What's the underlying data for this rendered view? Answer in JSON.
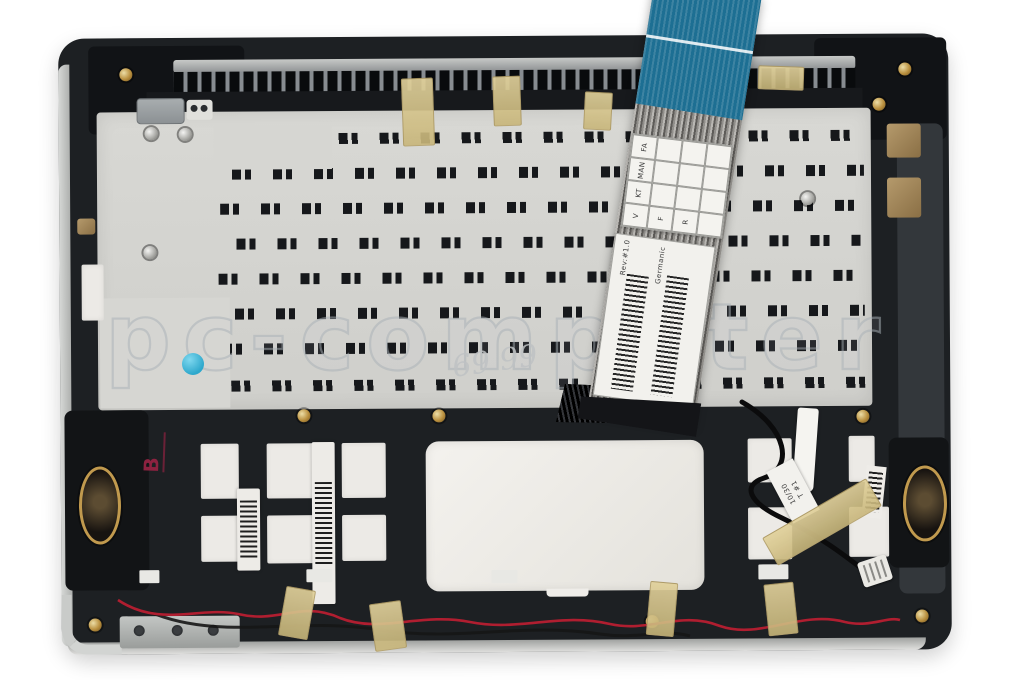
{
  "scene": {
    "type": "product-photo",
    "subject": "Laptop palmrest top case assembly with keyboard (inner/rear view) and attached keyboard ribbon cable",
    "background_color": "#ffffff"
  },
  "watermark": {
    "text": "pc-computer",
    "color": "#a8b0b6"
  },
  "markings": {
    "red_stamp": "B",
    "red_stamp_color": "#8d2240",
    "handwritten": "69 99",
    "blue_dot_color": "#35b6d9"
  },
  "cable": {
    "stiffener_color": "#1d6f93",
    "qc_grid": {
      "col_headers": [
        "FA",
        "MAN",
        "KT"
      ],
      "row_marks": [
        "V",
        "F",
        "R"
      ]
    },
    "label": {
      "line1": "Rev:#1.0",
      "line2": "Germanic"
    }
  },
  "labels": {
    "paper_tab_line1": "10/30",
    "paper_tab_line2": "T #1"
  },
  "colors": {
    "case": "#1d2023",
    "plate": "#d6d6d2",
    "touchpad": "#edebe6",
    "speaker_ring": "#c19a4e",
    "tape": "#d7c58f",
    "wire_red": "#b01e30",
    "cable_blue": "#1d6f93"
  }
}
